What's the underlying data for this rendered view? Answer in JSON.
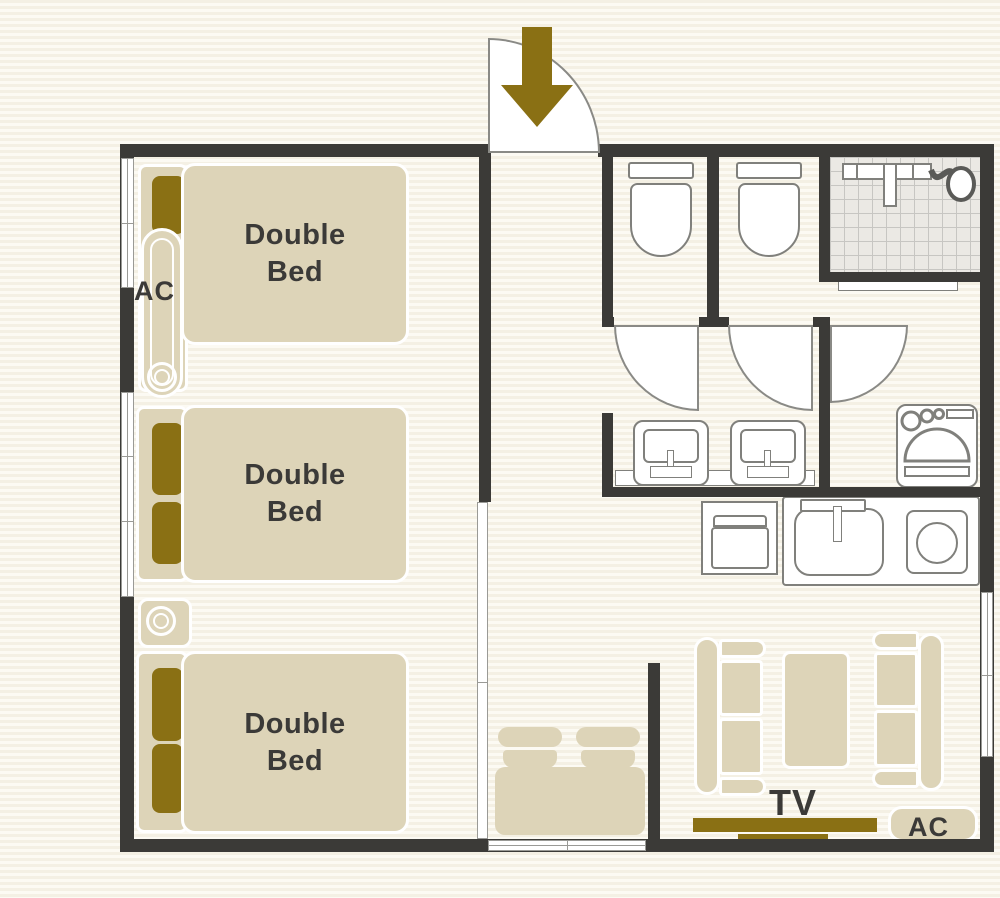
{
  "colors": {
    "wall": "#3b3a37",
    "gold": "#8a7014",
    "beige": "#ddd4b8",
    "text_dark": "#3b3a38",
    "outline": "#80807c",
    "arc": "#8a8a86"
  },
  "bedrooms": [
    {
      "id": "bedroom-1",
      "label_line1": "Double",
      "label_line2": "Bed"
    },
    {
      "id": "bedroom-2",
      "label_line1": "Double",
      "label_line2": "Bed"
    },
    {
      "id": "bedroom-3",
      "label_line1": "Double",
      "label_line2": "Bed"
    }
  ],
  "labels": {
    "ac_bedroom": "AC",
    "ac_living": "AC",
    "tv": "TV"
  },
  "fixtures": [
    "entrance-arrow-icon",
    "entrance-door-swing",
    "toilet",
    "toilet",
    "toilet-door-swing",
    "toilet-door-swing",
    "washroom-door-swing",
    "shower-tiled-area",
    "shower-head",
    "washbasin",
    "washbasin",
    "washing-machine",
    "refrigerator",
    "kitchen-sink",
    "stove-burner",
    "sofa",
    "sofa",
    "coffee-table",
    "tv-stand",
    "ac-unit",
    "ac-unit",
    "dining-chair",
    "dining-chair",
    "dining-table",
    "bed-pillow",
    "window"
  ]
}
